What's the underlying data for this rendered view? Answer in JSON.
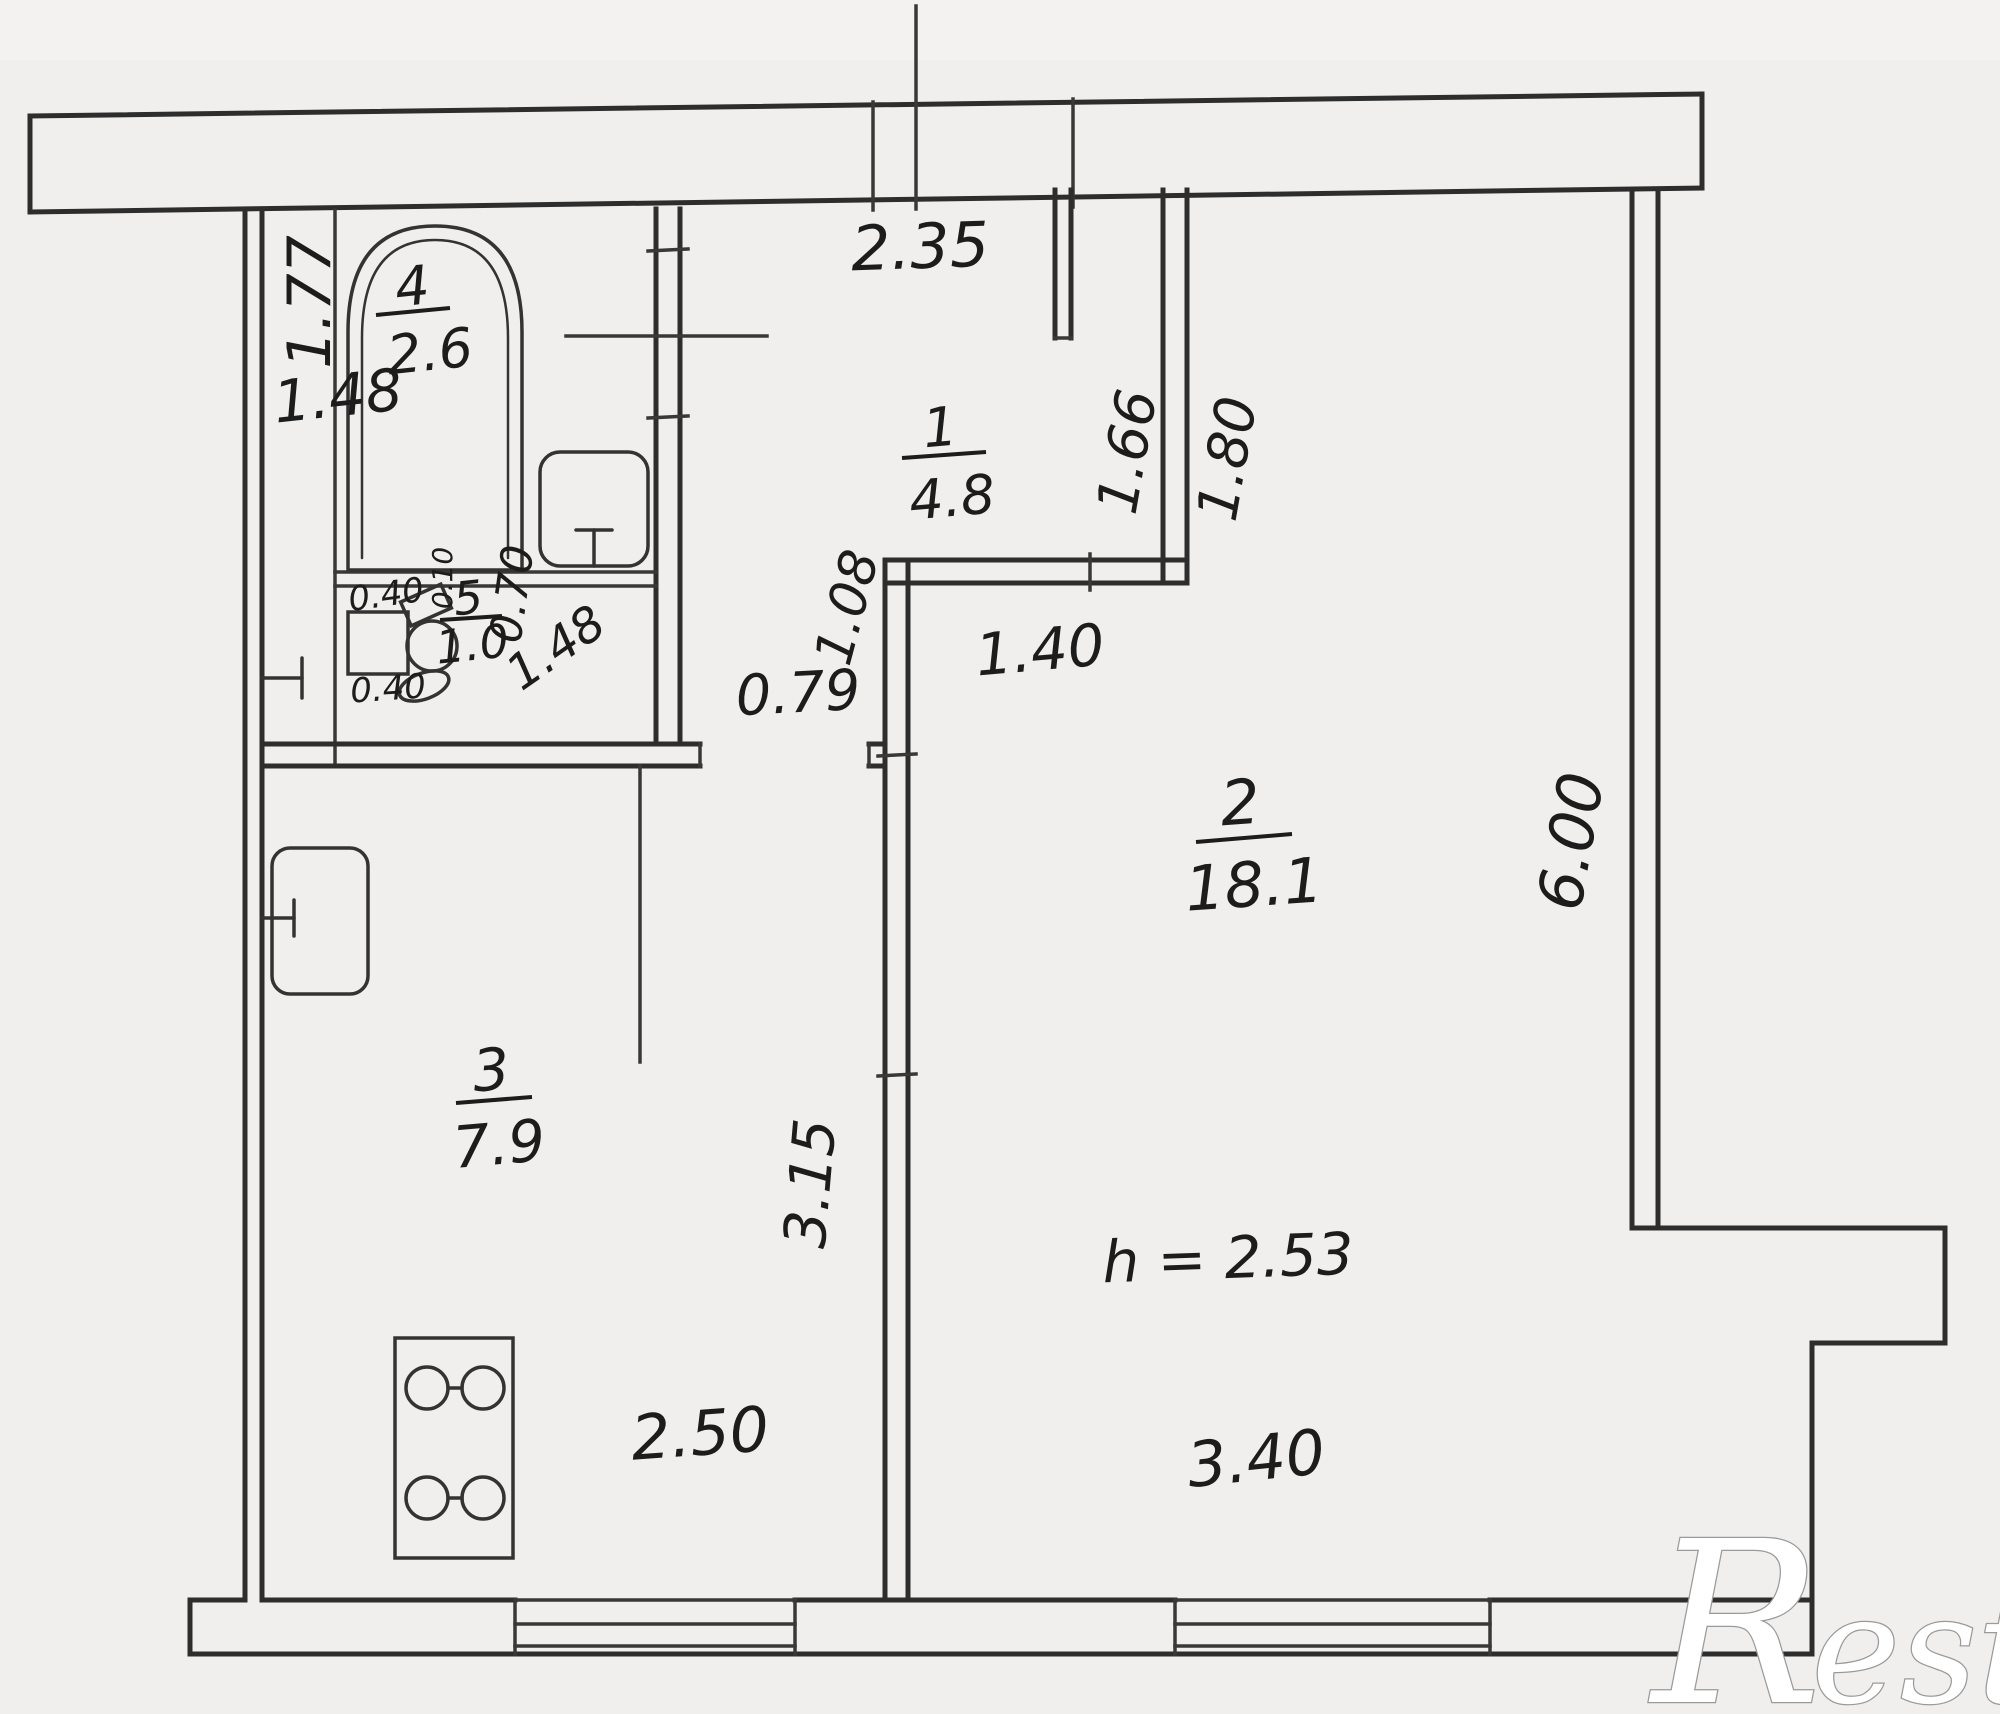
{
  "plan": {
    "watermark_r": "R",
    "watermark_rest": "estate",
    "ceiling_height": "h = 2.53",
    "rooms": [
      {
        "number": "1",
        "area": "4.8"
      },
      {
        "number": "2",
        "area": "18.1"
      },
      {
        "number": "3",
        "area": "7.9"
      },
      {
        "number": "4",
        "area": "2.6"
      },
      {
        "number": "5",
        "area": "1.0"
      }
    ],
    "dims": {
      "top_span": "2.35",
      "bath_length": "1.77",
      "bath_width": "1.48",
      "closet_inner": "1.66",
      "closet_outer": "1.80",
      "closet_width": "1.40",
      "hall_depth": "1.08",
      "hall_opening": "0.79",
      "wc_door": "0.70",
      "wc_diag": "1.48",
      "sink_top": "0.40",
      "sink_bottom": "0.40",
      "toilet_gap": "0.10",
      "room2_length": "6.00",
      "kitchen_wall": "3.15",
      "kitchen_window": "2.50",
      "room2_window": "3.40"
    }
  }
}
